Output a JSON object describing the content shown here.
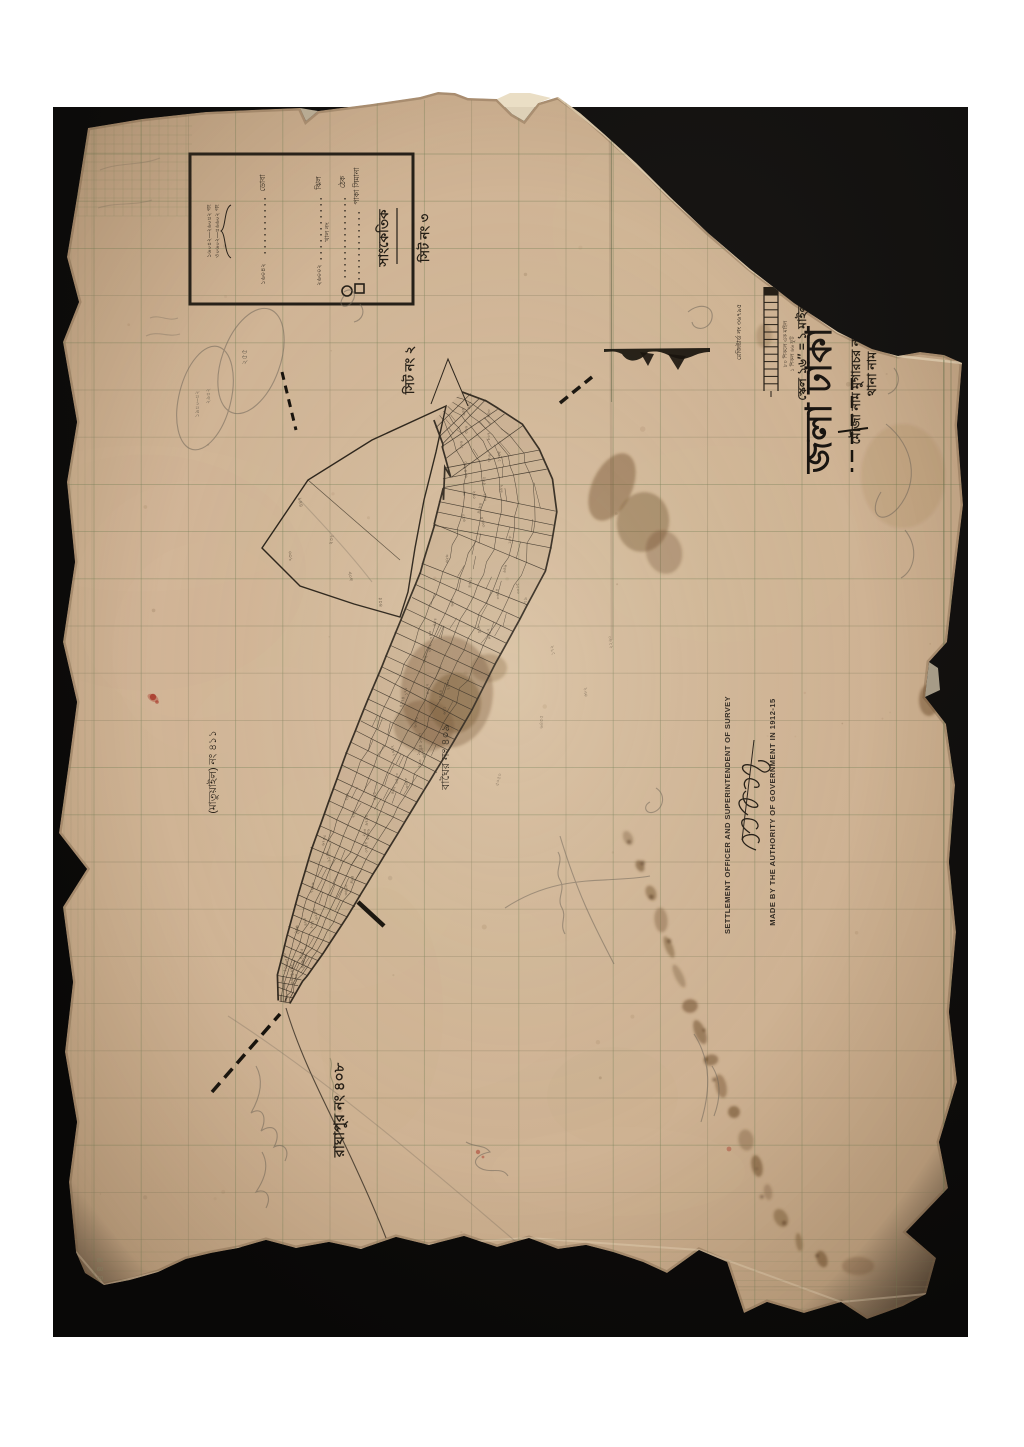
{
  "header": {
    "district_large": "জলা ঢাকা",
    "thana_line": "থানা নাম কেরাণীগঞ্জ",
    "mouza_line": "মৌজা নাম মুগারচর নং ৪১০",
    "scale_line": "স্কেল ১৬″ = ১ মাইল",
    "registered_no": "রেজিষ্টার্ড নং ৩৬৭৯৫",
    "scale_note_a": "৮০ শিকলে এক মাইল",
    "scale_note_b": "১ শিকল ৬৬ ফুট",
    "scale_bar_top": "৮০"
  },
  "legend": {
    "title": "সাংকেতিক",
    "rows": [
      {
        "label": "পাকা সিমানা",
        "symbol": "square",
        "value": ""
      },
      {
        "label": "ঠেক",
        "symbol": "circle",
        "value": ""
      },
      {
        "label": "ঝিল",
        "symbol": "none",
        "value": "২৬০০২"
      },
      {
        "label": "ডোবা",
        "symbol": "none",
        "value": "১৬০৪২"
      }
    ],
    "mid_note": "খাল নং",
    "note_line_1": "১৬০৪২—২৬০৪২ গং",
    "note_line_2": "৩০৬০২—৪৬৬০২ গং"
  },
  "sheet_labels": {
    "sheet_3": "সিট নং ৩",
    "sheet_2": "সিট নং ২"
  },
  "neighbor_labels": {
    "east": "বাঘৈর নং ৪০৯",
    "south": "রাঘাপুর নং ৪০৮",
    "west": "(মাতুয়াইল) নং ৪১১"
  },
  "english": {
    "authority_line": "MADE BY THE AUTHORITY OF GOVERNMENT IN 1912-15",
    "officer_line": "SETTLEMENT OFFICER AND SUPERINTENDENT OF SURVEY"
  },
  "pencil_notes": {
    "oval_1a": "১৯৪০–৪২",
    "oval_1b": "২৯৪২",
    "oval_2": "২৫৫"
  },
  "table_numbers": {
    "r1": "80",
    "r2": "60",
    "r3": "60"
  },
  "plot_digits_alphabet": "০১২৩৪৫৬৭৮৯",
  "colors": {
    "mat": "#0b0a09",
    "paper": "#cdb294",
    "ink": "#241e16",
    "grid": "#7f8a66",
    "stain": "#6b4a28",
    "pencil": "#6f665a",
    "red_mark": "#a52f22"
  }
}
